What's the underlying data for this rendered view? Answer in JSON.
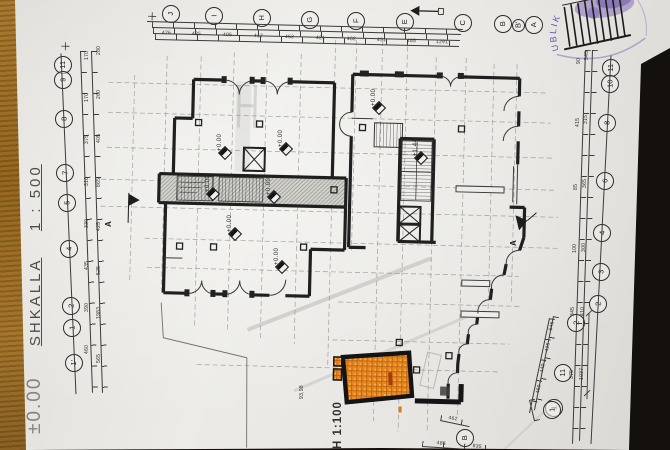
{
  "document": {
    "scale_text": {
      "level": "±0.00",
      "name": "SHKALLA",
      "ratio": "1 : 500"
    },
    "plan_scale_label": "H 1:100",
    "stamp_arc_text": "UBLIK"
  },
  "grid_bubbles": {
    "top": [
      "J",
      "I",
      "H",
      "G",
      "F",
      "E",
      "C",
      "B",
      "B'",
      "A"
    ],
    "left": [
      "11",
      "9",
      "8",
      "7",
      "5",
      "4",
      "2",
      "1",
      "1'"
    ],
    "right": [
      "11",
      "10",
      "8",
      "6",
      "4",
      "3",
      "2"
    ],
    "diagonal": [
      "2",
      "11",
      "1"
    ],
    "bottom": [
      "B",
      "1"
    ]
  },
  "level_markers": [
    "+0.00",
    "+0.00",
    "+0.00",
    "+0.00",
    "+0.00",
    "+0.00",
    "+0.00",
    "+1.44"
  ],
  "section_labels": [
    "A",
    "A"
  ],
  "dimensions": {
    "top": [
      "476",
      "435",
      "405",
      "417",
      "452",
      "421",
      "462",
      "451",
      "485",
      "1291"
    ],
    "left": [
      "170",
      "170",
      "375",
      "310",
      "330",
      "435",
      "390",
      "460",
      "280",
      "260",
      "405",
      "865",
      "425",
      "525",
      "1983",
      "565"
    ],
    "right": [
      "90",
      "415",
      "85",
      "100",
      "345",
      "375",
      "545",
      "315",
      "365",
      "300",
      "410",
      "1037"
    ],
    "diagonal": [
      "545",
      "415",
      "440",
      "460"
    ],
    "bottom": [
      "462",
      "485",
      "835",
      "93,98"
    ]
  },
  "colors": {
    "highlight_room": "#e8891f",
    "stamp_ink": "#6b55a8",
    "paper": "#e8e6e2",
    "wood": "#a2762c"
  }
}
